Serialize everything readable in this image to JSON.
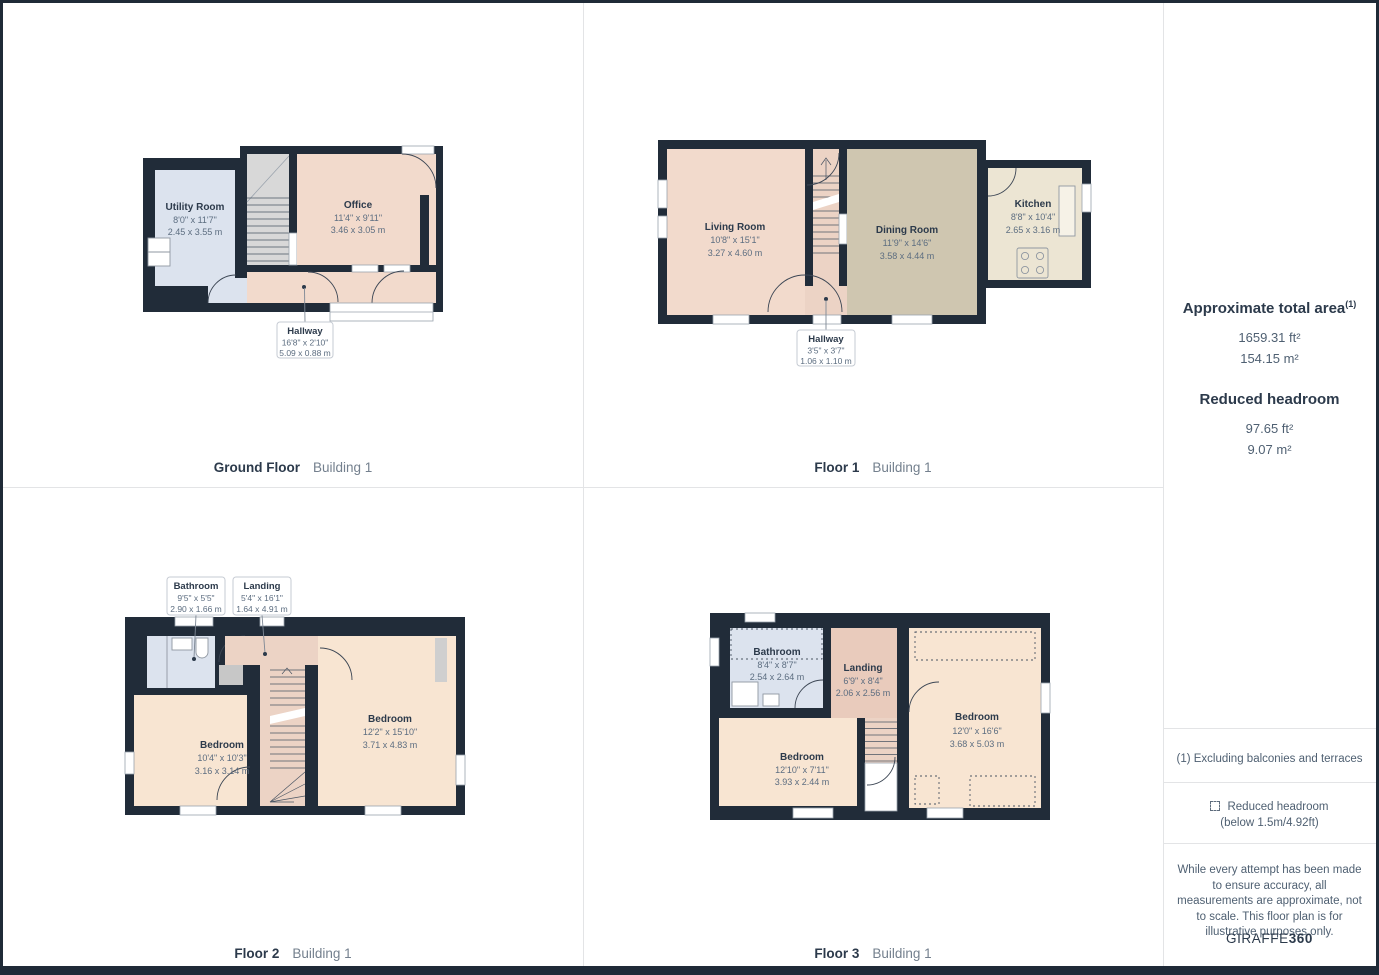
{
  "palette": {
    "wall": "#212c39",
    "room_peach": "#f2dacc",
    "bedroom_peach": "#f8e5d2",
    "stairs_peach": "#ecd3c5",
    "landing_peach": "#e9cbbc",
    "dining_khaki": "#cfc6b0",
    "kitchen_cream": "#ece5d3",
    "bath_blue": "#dce3ee",
    "stairs_gray": "#d8d8d8",
    "text_dark": "#2c3a4b",
    "text_dim": "#5c6d80"
  },
  "floors": [
    {
      "caption": "Ground Floor",
      "building": "Building 1",
      "rooms": {
        "utility": {
          "name": "Utility Room",
          "imperial": "8'0\" x 11'7\"",
          "metric": "2.45 x 3.55 m"
        },
        "office": {
          "name": "Office",
          "imperial": "11'4\" x 9'11\"",
          "metric": "3.46 x 3.05 m"
        },
        "hallway": {
          "name": "Hallway",
          "imperial": "16'8\" x 2'10\"",
          "metric": "5.09 x 0.88 m"
        }
      }
    },
    {
      "caption": "Floor 1",
      "building": "Building 1",
      "rooms": {
        "living": {
          "name": "Living Room",
          "imperial": "10'8\" x 15'1\"",
          "metric": "3.27 x 4.60 m"
        },
        "dining": {
          "name": "Dining Room",
          "imperial": "11'9\" x 14'6\"",
          "metric": "3.58 x 4.44 m"
        },
        "kitchen": {
          "name": "Kitchen",
          "imperial": "8'8\" x 10'4\"",
          "metric": "2.65 x 3.16 m"
        },
        "hallway": {
          "name": "Hallway",
          "imperial": "3'5\" x 3'7\"",
          "metric": "1.06 x 1.10 m"
        }
      }
    },
    {
      "caption": "Floor 2",
      "building": "Building 1",
      "rooms": {
        "bathroom": {
          "name": "Bathroom",
          "imperial": "9'5\" x 5'5\"",
          "metric": "2.90 x 1.66 m"
        },
        "landing": {
          "name": "Landing",
          "imperial": "5'4\" x 16'1\"",
          "metric": "1.64 x 4.91 m"
        },
        "bedroom1": {
          "name": "Bedroom",
          "imperial": "10'4\" x 10'3\"",
          "metric": "3.16 x 3.14 m"
        },
        "bedroom2": {
          "name": "Bedroom",
          "imperial": "12'2\" x 15'10\"",
          "metric": "3.71 x 4.83 m"
        }
      }
    },
    {
      "caption": "Floor 3",
      "building": "Building 1",
      "rooms": {
        "bathroom": {
          "name": "Bathroom",
          "imperial": "8'4\" x 8'7\"",
          "metric": "2.54 x 2.64 m"
        },
        "landing": {
          "name": "Landing",
          "imperial": "6'9\" x 8'4\"",
          "metric": "2.06 x 2.56 m"
        },
        "bedroom1": {
          "name": "Bedroom",
          "imperial": "12'10\" x 7'11\"",
          "metric": "3.93 x 2.44 m"
        },
        "bedroom2": {
          "name": "Bedroom",
          "imperial": "12'0\" x 16'6\"",
          "metric": "3.68 x 5.03 m"
        }
      }
    }
  ],
  "sidebar": {
    "total_area": {
      "heading": "Approximate total area",
      "footnote_marker": "(1)",
      "imperial": "1659.31 ft²",
      "metric": "154.15 m²"
    },
    "reduced_headroom": {
      "heading": "Reduced headroom",
      "imperial": "97.65 ft²",
      "metric": "9.07 m²"
    },
    "footnote": "(1) Excluding balconies and terraces",
    "legend": {
      "icon": "dashed-square",
      "line1": "Reduced headroom",
      "line2": "(below 1.5m/4.92ft)"
    },
    "disclaimer": "While every attempt has been made to ensure accuracy, all measurements are approximate, not to scale. This floor plan is for illustrative purposes only.",
    "brand": {
      "name_regular": "GIRAFFE",
      "name_bold": "360"
    }
  }
}
